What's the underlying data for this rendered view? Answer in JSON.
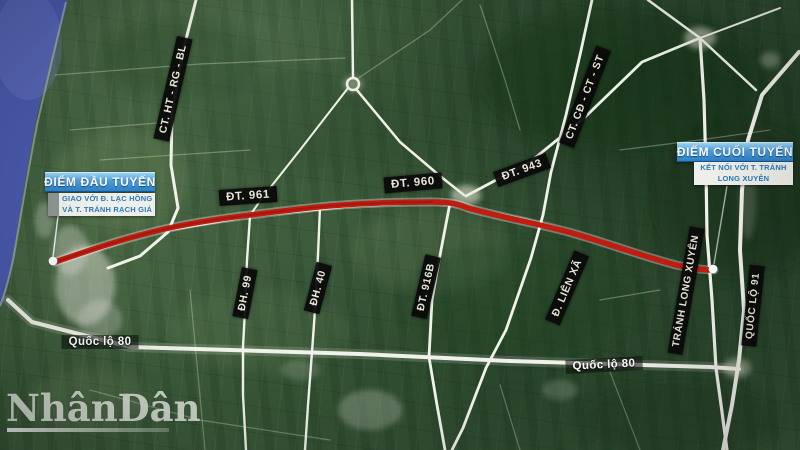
{
  "colors": {
    "route_red": "#c21c10",
    "water_blue": "#4a5bae",
    "road_white": "#f0f2ea",
    "marker_blue": "#2e82c8",
    "marker_blue_light": "#9ed4f2",
    "marker_subtitle_bg": "#edefe8",
    "marker_subtitle_text": "#2a79bd",
    "road_label_bg": "#0a0a0a",
    "road_label_text": "#f3efe2",
    "field_green": "#3d5c3c"
  },
  "markers": {
    "start": {
      "title": "ĐIỂM ĐẦU TUYẾN",
      "subtitle": [
        "GIAO VỚI Đ. LẠC HỒNG",
        "VÀ T. TRÁNH RẠCH GIÁ"
      ]
    },
    "end": {
      "title": "ĐIỂM CUỐI TUYẾN",
      "subtitle": [
        "KẾT NỐI VỚI T. TRÁNH",
        "LONG XUYÊN"
      ]
    }
  },
  "road_labels": [
    {
      "text": "CT. HT - RG - BL"
    },
    {
      "text": "CT. CĐ - CT - ST"
    },
    {
      "text": "ĐT. 961"
    },
    {
      "text": "ĐT. 960"
    },
    {
      "text": "ĐT. 943"
    },
    {
      "text": "ĐH. 99"
    },
    {
      "text": "ĐH. 40"
    },
    {
      "text": "ĐT. 916B"
    },
    {
      "text": "Đ. LIÊN XÃ"
    },
    {
      "text": "TRÁNH LONG XUYÊN"
    },
    {
      "text": "QUỐC LỘ 91"
    },
    {
      "text": "Quốc lộ 80"
    },
    {
      "text": "Quốc lộ 80"
    }
  ],
  "watermark": {
    "text": "NhânDân"
  }
}
